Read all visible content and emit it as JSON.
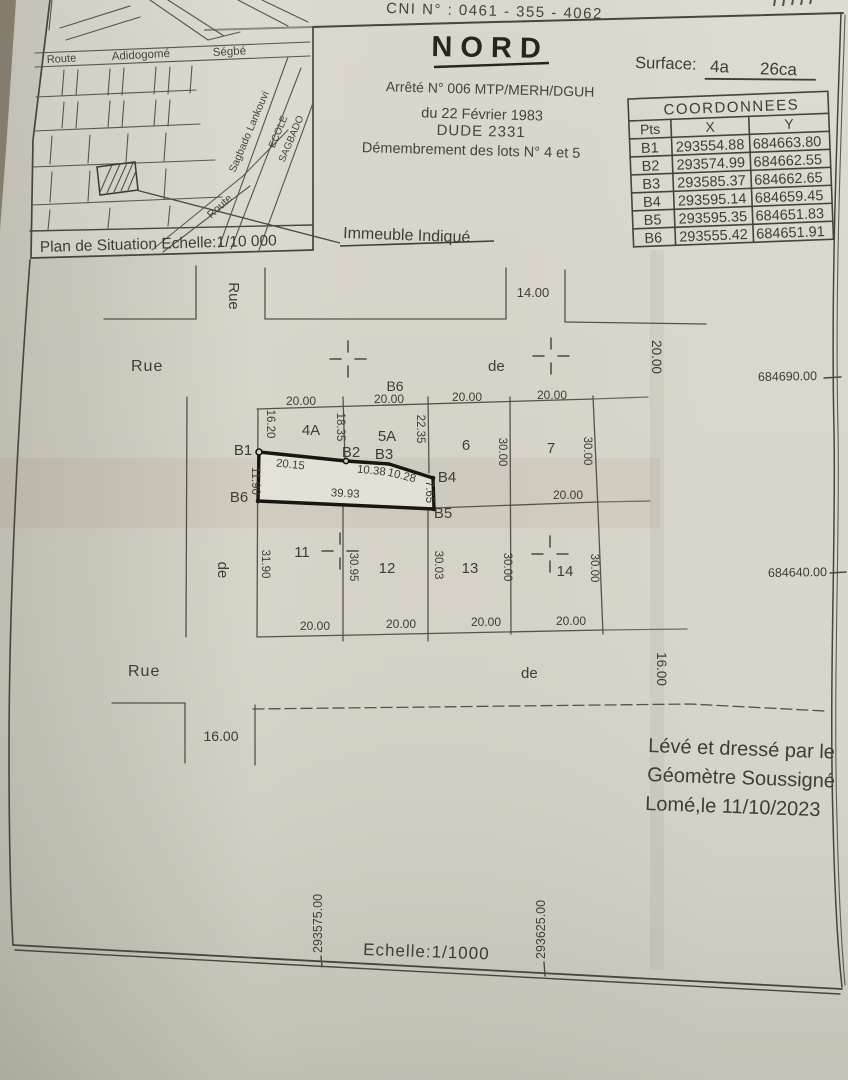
{
  "page": {
    "bg": "#6e695d",
    "paper": "#d7d4c8",
    "ink": "#3f3d35",
    "accent_bold": "#17160f"
  },
  "header": {
    "cni": "CNI N° : 0461 - 355 - 4062",
    "title": "NORD",
    "surface_label": "Surface:",
    "surface_a": "4a",
    "surface_ca": "26ca",
    "decree_line1": "Arrêté N° 006 MTP/MERH/DGUH",
    "decree_line2": "du 22 Février 1983",
    "decree_line3": "DUDE 2331",
    "decree_line4": "Démembrement des lots N° 4 et 5",
    "immeuble": "Immeuble Indiqué"
  },
  "situation_map": {
    "caption": "Plan de Situation Echelle:1/10 000",
    "route": "Route",
    "adidogome": "Adidogomé",
    "segbe": "Ségbé",
    "lankouvi": "Sagbado  Lankouvi",
    "ecole": "ECOLE",
    "sagbado": "SAGBADO",
    "route2": "Route"
  },
  "table": {
    "title": "COORDONNEES",
    "col_pts": "Pts",
    "col_x": "X",
    "col_y": "Y",
    "rows": [
      {
        "pt": "B1",
        "x": "293554.88",
        "y": "684663.80"
      },
      {
        "pt": "B2",
        "x": "293574.99",
        "y": "684662.55"
      },
      {
        "pt": "B3",
        "x": "293585.37",
        "y": "684662.65"
      },
      {
        "pt": "B4",
        "x": "293595.14",
        "y": "684659.45"
      },
      {
        "pt": "B5",
        "x": "293595.35",
        "y": "684651.83"
      },
      {
        "pt": "B6",
        "x": "293555.42",
        "y": "684651.91"
      }
    ]
  },
  "plan": {
    "street_rue_top": "Rue",
    "street_de_top": "de",
    "street_rue_bottom": "Rue",
    "street_de_bottom": "de",
    "street_rue_vert": "Rue",
    "street_de_vert": "de",
    "width_14": "14.00",
    "width_20": "20.00",
    "width_16_right": "16.00",
    "width_16_left": "16.00",
    "b6_street": "B6",
    "lots_upper": [
      "4A",
      "5A",
      "6",
      "7"
    ],
    "lots_lower": [
      "11",
      "12",
      "13",
      "14"
    ],
    "points": {
      "b1": "B1",
      "b2": "B2",
      "b3": "B3",
      "b4": "B4",
      "b5": "B5",
      "b6": "B6"
    },
    "top_dims": [
      "20.00",
      "20.00",
      "20.00",
      "20.00"
    ],
    "bottom_dims": [
      "20.00",
      "20.00",
      "20.00",
      "20.00"
    ],
    "upper_depths": [
      "16.20",
      "18.35",
      "22.35",
      "30.00",
      "30.00"
    ],
    "lower_depths": [
      "31.90",
      "30.95",
      "30.03",
      "30.00",
      "30.00"
    ],
    "lot7_south": "20.00",
    "parcel_dims": {
      "b1b2": "20.15",
      "b2b3": "10.38",
      "b3b4": "10.28",
      "b4b5": "7.65",
      "b6b5": "39.93",
      "b1b6": "11.90"
    },
    "grid": {
      "right_top": "684690.00",
      "right_bottom": "684640.00",
      "bottom_left": "293575.00",
      "bottom_right": "293625.00"
    }
  },
  "footer": {
    "scale": "Echelle:1/1000",
    "surveyor_line1": "Lévé et dressé par le",
    "surveyor_line2": "Géomètre Soussigné",
    "surveyor_line3": "Lomé,le 11/10/2023"
  }
}
